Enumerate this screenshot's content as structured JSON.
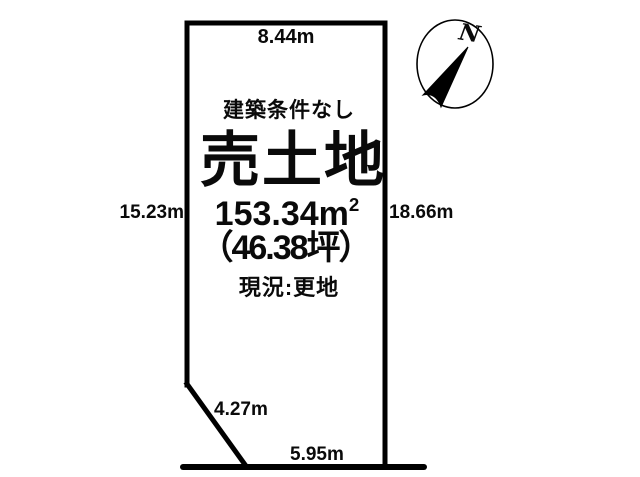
{
  "page": {
    "background": "#ffffff",
    "ink": "#000000",
    "description": "Land plot survey diagram for a property listing"
  },
  "compass": {
    "north_label": "N"
  },
  "plot": {
    "condition": "建築条件なし",
    "title": "売土地",
    "area_m2": "153.34m",
    "area_m2_sup": "2",
    "area_tsubo": "（46.38坪）",
    "status": "現況:更地",
    "dimensions": {
      "top": "8.44m",
      "left": "15.23m",
      "right": "18.66m",
      "diagonal": "4.27m",
      "bottom": "5.95m"
    }
  }
}
